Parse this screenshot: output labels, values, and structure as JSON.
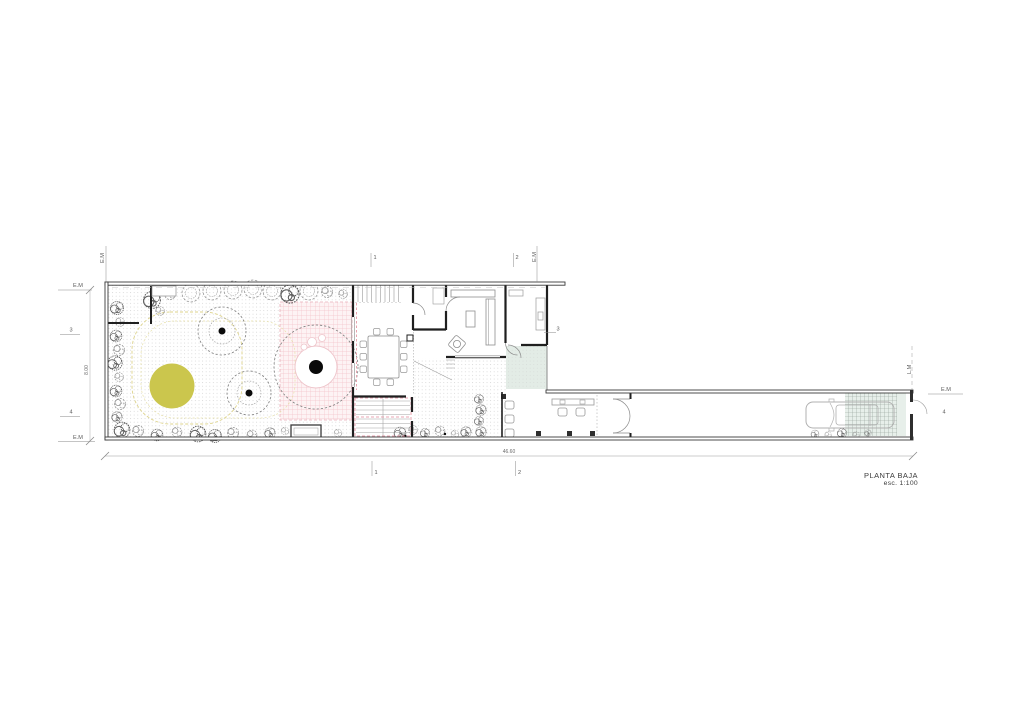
{
  "title_block": {
    "title": "PLANTA BAJA",
    "scale_label": "esc. 1:100"
  },
  "dimensions": {
    "overall_length": "46.60",
    "plot_width": "8.00"
  },
  "markers": {
    "property_line": "E.M",
    "street_line": "L.M",
    "section_1": "1",
    "section_2": "2",
    "section_3": "3",
    "section_4": "4"
  },
  "colors": {
    "walls": "#3a3a3a",
    "interior_walls": "#1f1f1f",
    "light_lines": "#9a9a9a",
    "vegetation": "#8c8c8c",
    "tree_trunk": "#0a0a0a",
    "lawn_circle_yellow": "#cbc64d",
    "pink_hatch": "#f3c3ca",
    "entry_tint_green": "#e3ece6",
    "annotation_text": "#5a5a5a"
  }
}
